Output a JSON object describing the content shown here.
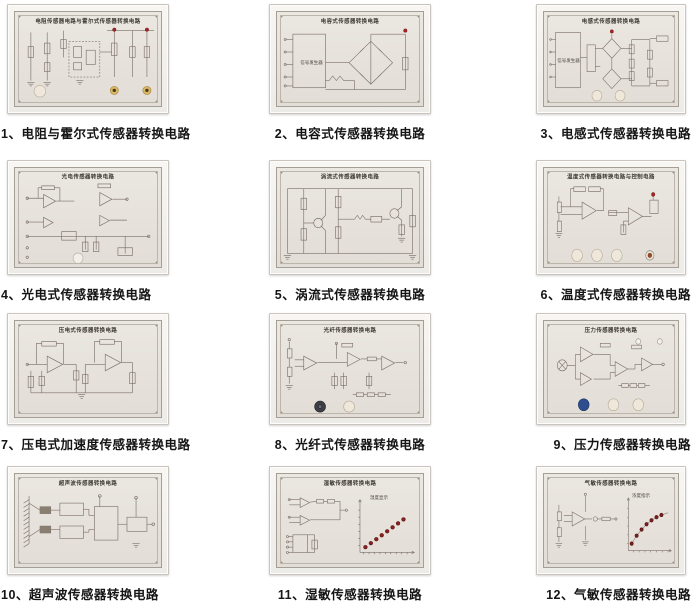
{
  "colors": {
    "line": "#7b7068",
    "led_red": "#a82525",
    "knob_cream": "#efe8da",
    "knob_white": "#f2efe8",
    "knob_dark": "#3e3e48",
    "knob_blue": "#2e4e8f",
    "jack_gold": "#d8b766",
    "panel_face": "#e7e2db",
    "caption_text": "#151515"
  },
  "panels": [
    {
      "caption": "1、电阻与霍尔式传感器转换电路",
      "title": "电阻传感器电路与霍尔式传感器转换电路",
      "art": "hall"
    },
    {
      "caption": "2、电容式传感器转换电路",
      "title": "电容式传感器转换电路",
      "art": "capbridge",
      "inner_label": "信号发生器"
    },
    {
      "caption": "3、电感式传感器转换电路",
      "title": "电感式传感器转换电路",
      "art": "inductive",
      "inner_label": "信号发生器"
    },
    {
      "caption": "4、光电式传感器转换电路",
      "title": "光电传感器转换电路",
      "art": "photoelec"
    },
    {
      "caption": "5、涡流式传感器转换电路",
      "title": "涡流式传感器转换电路",
      "art": "eddy"
    },
    {
      "caption": "6、温度式传感器转换电路",
      "title": "温度式传感器转换电路与控制电路",
      "art": "temp"
    },
    {
      "caption": "7、压电式加速度传感器转换电路",
      "title": "压电式传感器转换电路",
      "art": "piezo"
    },
    {
      "caption": "8、光纤式传感器转换电路",
      "title": "光纤传感器转换电路",
      "art": "fiber"
    },
    {
      "caption": "9、压力传感器转换电路",
      "title": "压力传感器转换电路",
      "art": "pressure"
    },
    {
      "caption": "10、超声波传感器转换电路",
      "title": "超声波传感器转换电路",
      "art": "ultra"
    },
    {
      "caption": "11、湿敏传感器转换电路",
      "title": "湿敏传感器转换电路",
      "art": "humid",
      "inner_label": "湿度显示"
    },
    {
      "caption": "12、气敏传感器转换电路",
      "title": "气敏传感器转换电路",
      "art": "gas",
      "inner_label": "浓度指示"
    }
  ]
}
